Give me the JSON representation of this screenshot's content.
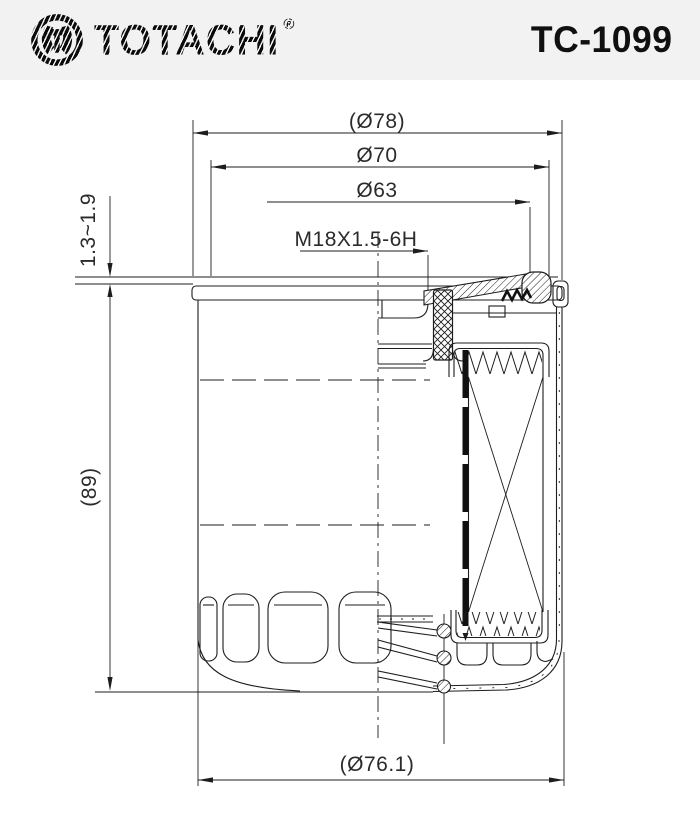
{
  "header": {
    "brand": "TOTACHI",
    "registered": "®",
    "part_number": "TC-1099",
    "bg_color": "#f2f2f2",
    "text_color": "#0b0b0b"
  },
  "drawing": {
    "type": "oil-filter-cross-section",
    "line_color": "#1d1d1d",
    "bg_color": "#ffffff",
    "dimensions": {
      "outer_diameter": "(Ø78)",
      "body_diameter": "Ø70",
      "gasket_diameter": "Ø63",
      "thread_spec": "M18X1.5-6H",
      "seam_thickness": "1.3~1.9",
      "overall_height": "(89)",
      "base_diameter": "(Ø76.1)"
    }
  }
}
